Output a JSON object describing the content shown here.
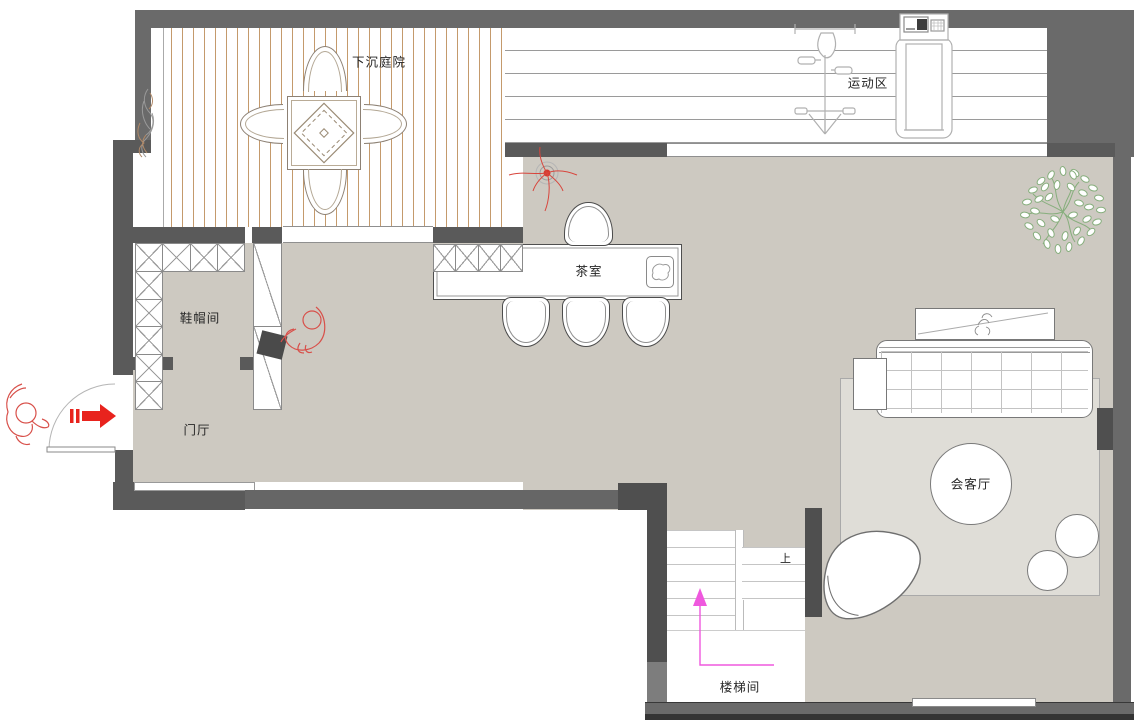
{
  "labels": {
    "courtyard": "下沉庭院",
    "gym": "运动区",
    "tea_room": "茶室",
    "cloakroom": "鞋帽间",
    "foyer": "门厅",
    "reception": "会客厅",
    "stairwell": "楼梯间",
    "stairs_up": "上"
  },
  "colors": {
    "wall_outer": "#6a6a6a",
    "wall_inner": "#5a5a5a",
    "wall_dark": "#4f4f4f",
    "floor": "#cdc9c1",
    "rug": "#dfddd7",
    "deck_line": "#c49a6c",
    "accent_red": "#e8231d",
    "sketch_red": "#d8504a",
    "path_magenta": "#ef58de",
    "plant_green": "#86ae7c"
  }
}
